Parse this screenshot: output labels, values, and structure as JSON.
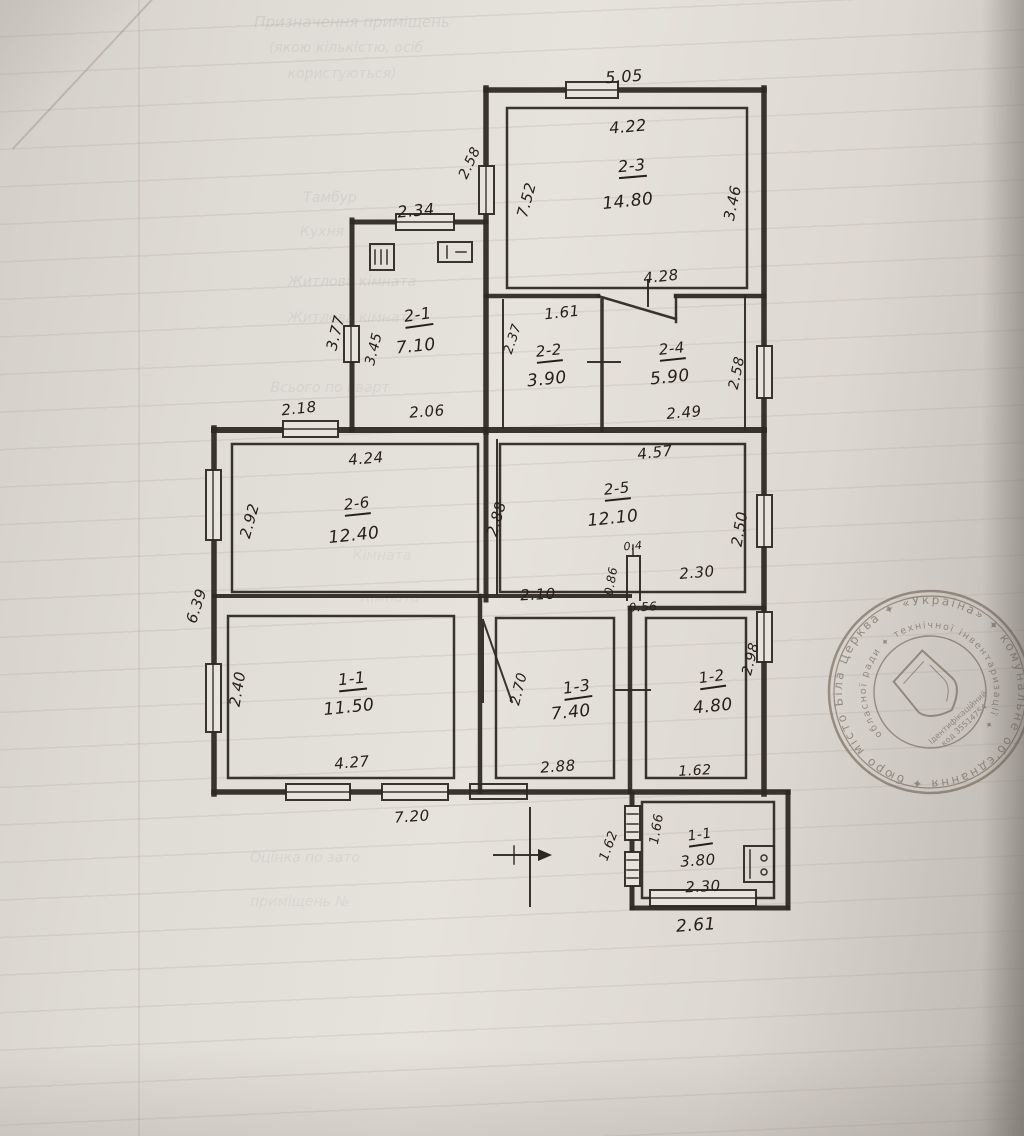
{
  "plan": {
    "labels": [
      {
        "name": "dim-top-5-05",
        "text": "5.05",
        "x": 624,
        "y": 77,
        "r": -4,
        "s": 16
      },
      {
        "name": "dim-2-3-width",
        "text": "4.22",
        "x": 628,
        "y": 127,
        "r": -5,
        "s": 16
      },
      {
        "name": "room-2-3-number",
        "text": "2-3",
        "x": 632,
        "y": 168,
        "r": -5,
        "s": 16,
        "u": true
      },
      {
        "name": "room-2-3-area",
        "text": "14.80",
        "x": 628,
        "y": 202,
        "r": -6,
        "s": 17
      },
      {
        "name": "dim-2-3-right-3-46",
        "text": "3.46",
        "x": 733,
        "y": 203,
        "r": -78,
        "s": 15
      },
      {
        "name": "dim-2-3-left-7-52",
        "text": "7.52",
        "x": 527,
        "y": 200,
        "r": -75,
        "s": 15
      },
      {
        "name": "dim-annex-left-2-58",
        "text": "2.58",
        "x": 470,
        "y": 163,
        "r": -65,
        "s": 14
      },
      {
        "name": "dim-2-3-bottom-4-28",
        "text": "4.28",
        "x": 661,
        "y": 277,
        "r": -6,
        "s": 15
      },
      {
        "name": "dim-2-1-top-2-34",
        "text": "2.34",
        "x": 416,
        "y": 211,
        "r": -5,
        "s": 16
      },
      {
        "name": "room-2-1-number",
        "text": "2-1",
        "x": 418,
        "y": 317,
        "r": -8,
        "s": 16,
        "u": true
      },
      {
        "name": "room-2-1-area",
        "text": "7.10",
        "x": 416,
        "y": 347,
        "r": -6,
        "s": 17
      },
      {
        "name": "dim-2-1-left-3-77",
        "text": "3.77",
        "x": 336,
        "y": 333,
        "r": -76,
        "s": 15
      },
      {
        "name": "dim-2-1-left-3-45",
        "text": "3.45",
        "x": 374,
        "y": 349,
        "r": -76,
        "s": 14
      },
      {
        "name": "dim-2-2-top-1-61",
        "text": "1.61",
        "x": 562,
        "y": 313,
        "r": -6,
        "s": 15
      },
      {
        "name": "dim-2-2-left-2-37",
        "text": "2.37",
        "x": 513,
        "y": 339,
        "r": -72,
        "s": 13
      },
      {
        "name": "room-2-2-number",
        "text": "2-2",
        "x": 549,
        "y": 353,
        "r": -6,
        "s": 15,
        "u": true
      },
      {
        "name": "room-2-2-area",
        "text": "3.90",
        "x": 547,
        "y": 380,
        "r": -6,
        "s": 17
      },
      {
        "name": "room-2-4-number",
        "text": "2-4",
        "x": 672,
        "y": 351,
        "r": -6,
        "s": 15,
        "u": true
      },
      {
        "name": "room-2-4-area",
        "text": "5.90",
        "x": 670,
        "y": 378,
        "r": -6,
        "s": 17
      },
      {
        "name": "dim-2-4-right-2-58",
        "text": "2.58",
        "x": 737,
        "y": 373,
        "r": -78,
        "s": 14
      },
      {
        "name": "dim-2-4-bottom-2-49",
        "text": "2.49",
        "x": 684,
        "y": 413,
        "r": -5,
        "s": 15
      },
      {
        "name": "dim-band-2-18",
        "text": "2.18",
        "x": 299,
        "y": 409,
        "r": -6,
        "s": 15
      },
      {
        "name": "dim-band-2-06",
        "text": "2.06",
        "x": 427,
        "y": 412,
        "r": -4,
        "s": 15
      },
      {
        "name": "dim-2-6-top-4-24",
        "text": "4.24",
        "x": 366,
        "y": 459,
        "r": -5,
        "s": 15
      },
      {
        "name": "room-2-6-number",
        "text": "2-6",
        "x": 357,
        "y": 506,
        "r": -6,
        "s": 15,
        "u": true
      },
      {
        "name": "room-2-6-area",
        "text": "12.40",
        "x": 354,
        "y": 536,
        "r": -6,
        "s": 17
      },
      {
        "name": "dim-2-6-left-2-92",
        "text": "2.92",
        "x": 250,
        "y": 521,
        "r": -74,
        "s": 15
      },
      {
        "name": "dim-outer-left-6-39",
        "text": "6.39",
        "x": 197,
        "y": 606,
        "r": -72,
        "s": 15
      },
      {
        "name": "dim-2-5-top-4-57",
        "text": "4.57",
        "x": 655,
        "y": 453,
        "r": -6,
        "s": 15
      },
      {
        "name": "room-2-5-number",
        "text": "2-5",
        "x": 617,
        "y": 491,
        "r": -6,
        "s": 15,
        "u": true
      },
      {
        "name": "room-2-5-area",
        "text": "12.10",
        "x": 613,
        "y": 519,
        "r": -6,
        "s": 17
      },
      {
        "name": "dim-2-5-right-2-50",
        "text": "2.50",
        "x": 740,
        "y": 529,
        "r": -80,
        "s": 15
      },
      {
        "name": "dim-2-5-left-2-88",
        "text": "2.88",
        "x": 497,
        "y": 519,
        "r": -74,
        "s": 15
      },
      {
        "name": "dim-mid-2-10",
        "text": "2.10",
        "x": 538,
        "y": 595,
        "r": -3,
        "s": 15
      },
      {
        "name": "dim-stub-0-86",
        "text": "0.86",
        "x": 611,
        "y": 581,
        "r": -80,
        "s": 12
      },
      {
        "name": "dim-stub-0-4",
        "text": "0.4",
        "x": 633,
        "y": 546,
        "r": -5,
        "s": 11
      },
      {
        "name": "dim-mid-2-30",
        "text": "2.30",
        "x": 697,
        "y": 573,
        "r": -5,
        "s": 15
      },
      {
        "name": "dim-mid-0-56",
        "text": "0.56",
        "x": 643,
        "y": 607,
        "r": -3,
        "s": 12
      },
      {
        "name": "room-1-1-number",
        "text": "1-1",
        "x": 352,
        "y": 681,
        "r": -6,
        "s": 16,
        "u": true
      },
      {
        "name": "room-1-1-area",
        "text": "11.50",
        "x": 349,
        "y": 708,
        "r": -6,
        "s": 17
      },
      {
        "name": "dim-1-1-left-2-40",
        "text": "2.40",
        "x": 238,
        "y": 689,
        "r": -80,
        "s": 15
      },
      {
        "name": "dim-1-1-bottom-4-27",
        "text": "4.27",
        "x": 352,
        "y": 763,
        "r": -5,
        "s": 15
      },
      {
        "name": "dim-outer-bottom-7-20",
        "text": "7.20",
        "x": 412,
        "y": 817,
        "r": -4,
        "s": 15
      },
      {
        "name": "room-1-3-number",
        "text": "1-3",
        "x": 577,
        "y": 689,
        "r": -8,
        "s": 16,
        "u": true
      },
      {
        "name": "room-1-3-area",
        "text": "7.40",
        "x": 571,
        "y": 713,
        "r": -6,
        "s": 17
      },
      {
        "name": "dim-1-3-left-2-70",
        "text": "2.70",
        "x": 519,
        "y": 689,
        "r": -76,
        "s": 14
      },
      {
        "name": "dim-1-3-bottom-2-88",
        "text": "2.88",
        "x": 558,
        "y": 767,
        "r": -4,
        "s": 15
      },
      {
        "name": "room-1-2-number",
        "text": "1-2",
        "x": 712,
        "y": 679,
        "r": -8,
        "s": 15,
        "u": true
      },
      {
        "name": "room-1-2-area",
        "text": "4.80",
        "x": 713,
        "y": 707,
        "r": -6,
        "s": 17
      },
      {
        "name": "dim-1-2-right-2-98",
        "text": "2.98",
        "x": 751,
        "y": 659,
        "r": -76,
        "s": 14
      },
      {
        "name": "dim-1-2-bottom-1-62",
        "text": "1.62",
        "x": 695,
        "y": 771,
        "r": -3,
        "s": 14
      },
      {
        "name": "dim-annex2-left-1-66",
        "text": "1.66",
        "x": 657,
        "y": 829,
        "r": -80,
        "s": 13
      },
      {
        "name": "dim-annex2-out-1-62",
        "text": "1.62",
        "x": 609,
        "y": 846,
        "r": -70,
        "s": 13
      },
      {
        "name": "room-annex-number",
        "text": "1-1",
        "x": 700,
        "y": 837,
        "r": -8,
        "s": 14,
        "u": true
      },
      {
        "name": "room-annex-area",
        "text": "3.80",
        "x": 698,
        "y": 861,
        "r": -4,
        "s": 15
      },
      {
        "name": "dim-annex2-bottom-2-30",
        "text": "2.30",
        "x": 703,
        "y": 887,
        "r": -3,
        "s": 15
      },
      {
        "name": "dim-annex2-out-2-61",
        "text": "2.61",
        "x": 696,
        "y": 926,
        "r": -4,
        "s": 17
      }
    ]
  },
  "ghost_text": [
    {
      "name": "ghost-heading-1",
      "text": "Призначення приміщень",
      "x": 352,
      "y": 22,
      "s": 15,
      "o": 0.13
    },
    {
      "name": "ghost-heading-2",
      "text": "(якою кількістю, осіб",
      "x": 346,
      "y": 48,
      "s": 14,
      "o": 0.11
    },
    {
      "name": "ghost-heading-3",
      "text": "користуються)",
      "x": 342,
      "y": 74,
      "s": 14,
      "o": 0.1
    },
    {
      "name": "ghost-row-tambur",
      "text": "Тамбур",
      "x": 330,
      "y": 198,
      "s": 14,
      "o": 0.12
    },
    {
      "name": "ghost-row-kitchen",
      "text": "Кухня",
      "x": 322,
      "y": 232,
      "s": 14,
      "o": 0.1
    },
    {
      "name": "ghost-row-living1",
      "text": "Житлова кімната",
      "x": 352,
      "y": 282,
      "s": 14,
      "o": 0.12
    },
    {
      "name": "ghost-row-living2",
      "text": "Житлова кімната",
      "x": 352,
      "y": 318,
      "s": 14,
      "o": 0.1
    },
    {
      "name": "ghost-row-total",
      "text": "Всього по кварт",
      "x": 330,
      "y": 388,
      "s": 14,
      "o": 0.1
    },
    {
      "name": "ghost-row-room1",
      "text": "Кімната",
      "x": 382,
      "y": 556,
      "s": 14,
      "o": 0.08
    },
    {
      "name": "ghost-row-room2",
      "text": "Кімната",
      "x": 390,
      "y": 598,
      "s": 14,
      "o": 0.08
    },
    {
      "name": "ghost-bottom-1",
      "text": "Оцінка по зато",
      "x": 305,
      "y": 858,
      "s": 14,
      "o": 0.1
    },
    {
      "name": "ghost-bottom-2",
      "text": "приміщень №",
      "x": 300,
      "y": 902,
      "s": 14,
      "o": 0.09
    }
  ],
  "stamp": {
    "outer_text": "місто Біла Церква ✦ «Україна» ✦ комунальне об'єднання ✦ бюро технічних підприємств ✦",
    "inner_text": "обласної ради ✦ технічної інвентаризації ✦",
    "center_line1": "Ідентифікаційний",
    "center_line2": "код 35514754"
  }
}
